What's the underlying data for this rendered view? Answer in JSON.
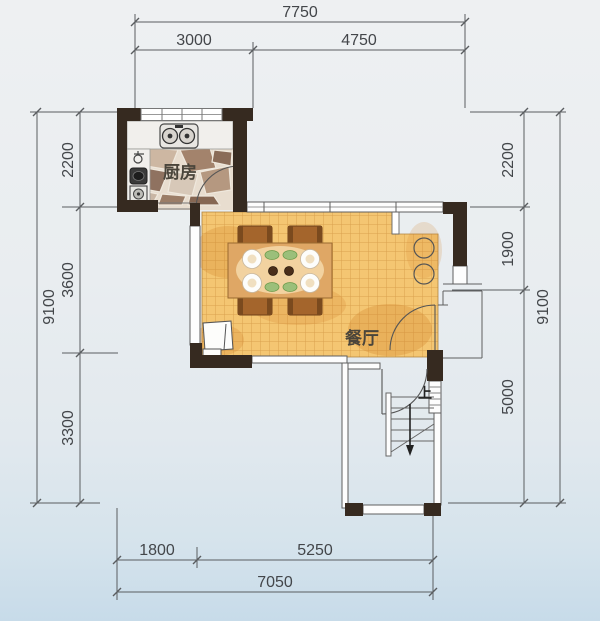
{
  "floorplan": {
    "rooms": {
      "kitchen_label": "厨房",
      "dining_label": "餐厅"
    },
    "stairs": {
      "direction_label": "上"
    },
    "dimensions": {
      "top": {
        "total": "7750",
        "segments": [
          "3000",
          "4750"
        ]
      },
      "bottom": {
        "total": "7050",
        "segments": [
          "1800",
          "5250"
        ]
      },
      "left": {
        "total": "9100",
        "segments": [
          "2200",
          "3600",
          "3300"
        ]
      },
      "right": {
        "total": "9100",
        "segments": [
          "2200",
          "1900",
          "5000"
        ]
      }
    },
    "colors": {
      "wall": "#362a20",
      "dining_tile": "#f4c672",
      "tile_grid": "#c98c3a",
      "dim_text": "#43464a",
      "wood_table": "#dfa765",
      "chair": "#a4652c"
    }
  }
}
